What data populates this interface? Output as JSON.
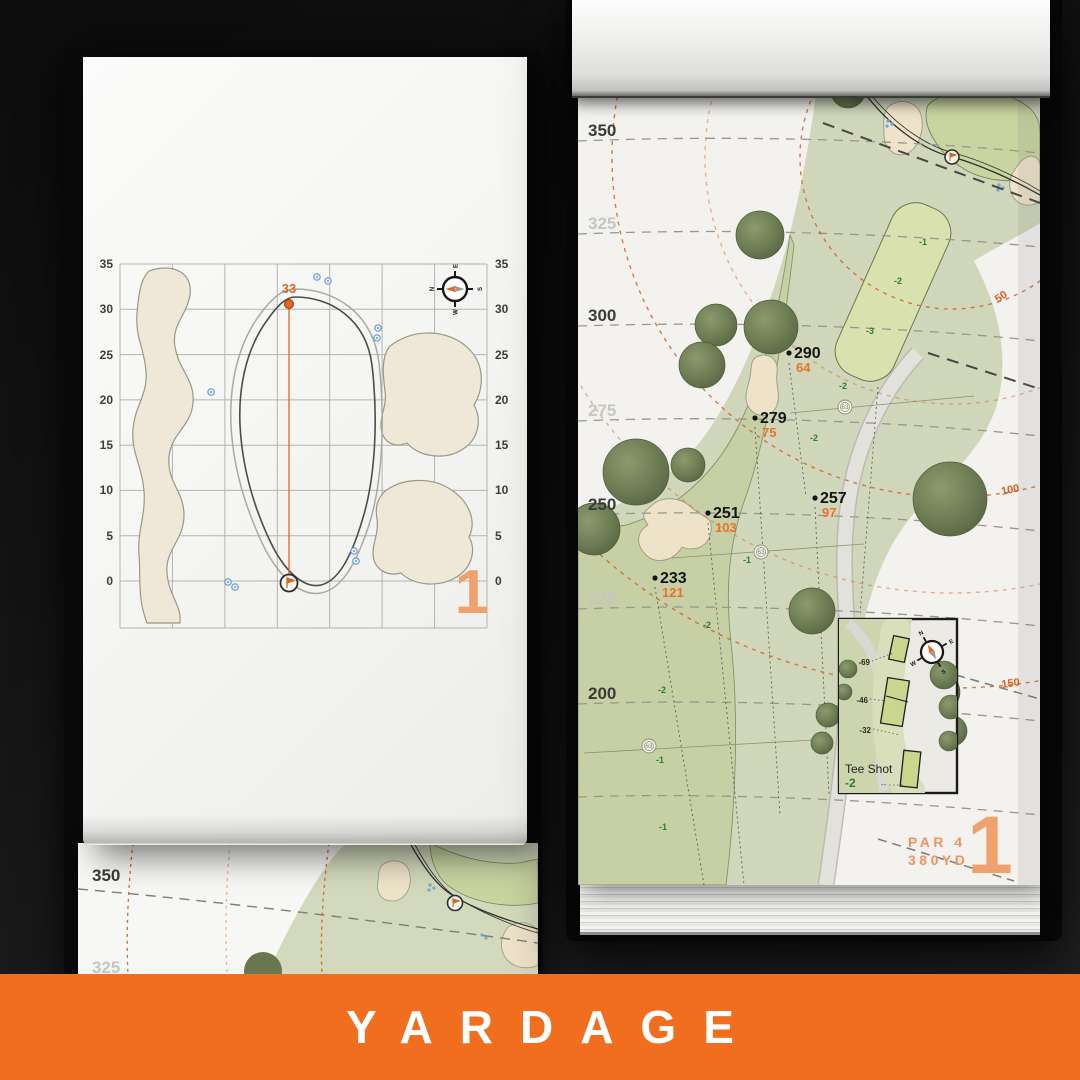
{
  "banner": {
    "label": "YARDAGE",
    "background": "#f06e1e",
    "text_color": "#ffffff"
  },
  "palette": {
    "accent_orange": "#e2661f",
    "muted_orange": "#efa26d",
    "slope_green": "#2f7d33",
    "rough_green": "#d2d9bc",
    "fairway_green": "#c5cfa2",
    "landing_green": "#d8e0ae",
    "bunker_sand": "#eee3c9",
    "tree_olive": "#68774f",
    "page_white": "#f3f2ef"
  },
  "left_book": {
    "detail_page": {
      "hole_number": "1",
      "pin_distance": "33",
      "axis_ticks": [
        "35",
        "30",
        "25",
        "20",
        "15",
        "10",
        "5",
        "0"
      ],
      "compass": {
        "n": "N",
        "e": "E",
        "s": "S",
        "w": "W"
      }
    },
    "under_page": {
      "labels": [
        "350",
        "325"
      ]
    }
  },
  "right_book": {
    "hole_page": {
      "hole_number": "1",
      "par": "PAR 4",
      "yardage": "380YD",
      "distance_labels": [
        "350",
        "325",
        "300",
        "275",
        "250",
        "225",
        "200"
      ],
      "arc_labels": [
        "50",
        "100",
        "150"
      ],
      "markers": [
        {
          "carry": "290",
          "remaining": "64"
        },
        {
          "carry": "279",
          "remaining": "75"
        },
        {
          "carry": "257",
          "remaining": "97"
        },
        {
          "carry": "251",
          "remaining": "103"
        },
        {
          "carry": "233",
          "remaining": "121"
        }
      ],
      "slope_labels": [
        "-1",
        "-2",
        "-3",
        "-2",
        "-2",
        "-1",
        "-2",
        "-2",
        "-1",
        "-1"
      ],
      "sprinklers": [
        "63",
        "63",
        "63"
      ],
      "compass": {
        "n": "N",
        "e": "E",
        "s": "S",
        "w": "W"
      },
      "tee_inset": {
        "title": "Tee Shot",
        "value": "-2",
        "tee_labels": [
          "-69",
          "-46",
          "-32"
        ],
        "dots": "--"
      }
    }
  }
}
